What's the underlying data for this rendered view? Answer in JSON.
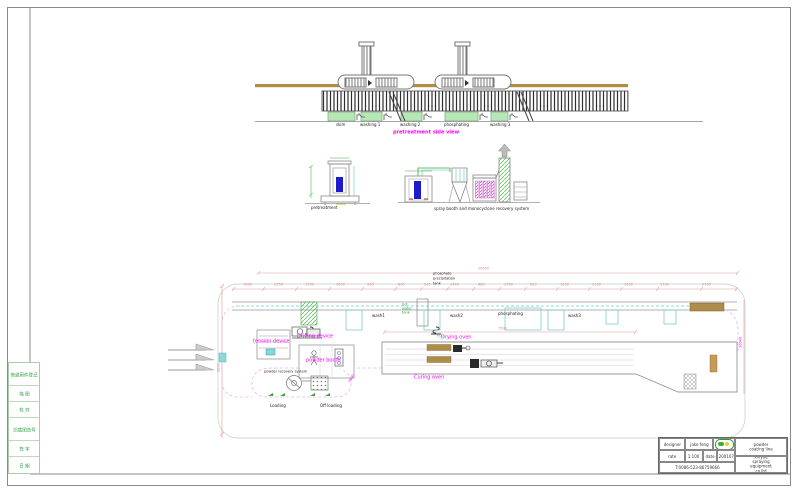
{
  "side_view": {
    "title": "pretreatment side view",
    "tank_labels": [
      "skim",
      "washing 1",
      "washing 2",
      "phosphating",
      "washing 3"
    ]
  },
  "elevations": {
    "left_label": "pretreatment",
    "right_label": "spray booth and monocyclone recovery system"
  },
  "plan": {
    "precip_tank_lines": [
      "phosphate",
      "precipitation",
      "tank"
    ],
    "hot_water_tank_lines": [
      "hot",
      "water",
      "tank"
    ],
    "station_labels": {
      "wash1": "wash1",
      "wash2": "wash2",
      "phosphating": "phosphating",
      "wash3": "wash3"
    },
    "area_labels": {
      "tension_device": "tension device",
      "driving_device": "Driving device",
      "powder_booth": "powder booth",
      "powder_recovery": "powder recovery system",
      "drying_oven": "Drying oven",
      "curing_oven": "Curing oven",
      "loading": "Loading",
      "off_loading": "Off loading"
    }
  },
  "dimensions": {
    "plan_total": "26050",
    "chain": [
      "1500",
      "2250",
      "1700",
      "3000",
      "950",
      "800",
      "945",
      "1445",
      "880",
      "1700",
      "620",
      "1050",
      "2150",
      "1500",
      "1700",
      "2700"
    ],
    "drying_oven_width": "7500",
    "left_height": "6600",
    "booth_exit": "7500",
    "right_curve": "10040",
    "conveyor_pitch": "7500"
  },
  "margin_table": {
    "rows": [
      "借通用件登记",
      "描 图",
      "校 对",
      "旧底图总号",
      "签 字",
      "日 期"
    ]
  },
  "title_block": {
    "designer_label": "designer",
    "designer_value": "jake feng",
    "scale_label": "rate",
    "scale_value": "1:100",
    "date_label": "date",
    "date_value": "200107",
    "phone": "T:0086-523-86759666",
    "product": "powder coating line",
    "company": "xinyue spraying equipment co.ltd"
  },
  "colors": {
    "accent_magenta": "#ff00ff",
    "dim_red": "#dd8888",
    "cad_cyan": "#55cccc",
    "cad_green": "#33aa33",
    "tan": "#b08c4a",
    "booth_blue": "#1c1ccc"
  }
}
